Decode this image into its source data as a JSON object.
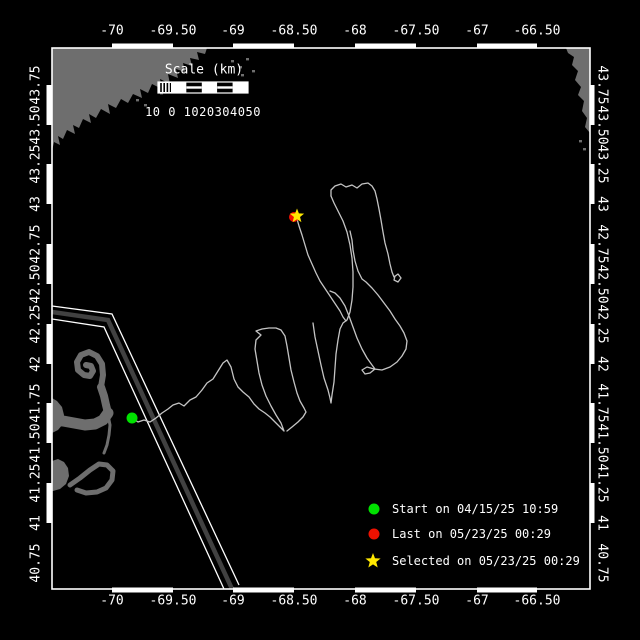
{
  "figure": {
    "width": 640,
    "height": 640,
    "background": "#000000"
  },
  "colors": {
    "frame": "#ffffff",
    "text": "#ffffff",
    "land": "#6e6e6e",
    "track": "#c4c4c4",
    "lane_band": "#414141",
    "lane_line": "#ffffff",
    "start": "#00e100",
    "last": "#ee1100",
    "selected": "#ffe800"
  },
  "plot": {
    "left": 52,
    "top": 48,
    "right": 590,
    "bottom": 589
  },
  "axes": {
    "top": {
      "labels": [
        "-70",
        "-69.50",
        "-69",
        "-68.50",
        "-68",
        "-67.50",
        "-67",
        "-66.50"
      ],
      "x": [
        112,
        173,
        233,
        294,
        355,
        416,
        477,
        537
      ],
      "y": 31
    },
    "bottom": {
      "labels": [
        "-70",
        "-69.50",
        "-69",
        "-68.50",
        "-68",
        "-67.50",
        "-67",
        "-66.50"
      ],
      "x": [
        112,
        173,
        233,
        294,
        355,
        416,
        477,
        537
      ],
      "y": 601
    },
    "left": {
      "labels": [
        "43.75",
        "43.50",
        "43.25",
        "43",
        "42.75",
        "42.50",
        "42.25",
        "42",
        "41.75",
        "41.50",
        "41.25",
        "41",
        "40.75"
      ],
      "y": [
        85,
        125,
        164,
        204,
        244,
        284,
        324,
        364,
        403,
        443,
        483,
        523,
        563
      ],
      "x": 36
    },
    "right": {
      "labels": [
        "43.75",
        "43.50",
        "43.25",
        "43",
        "42.75",
        "42.50",
        "42.25",
        "42",
        "41.75",
        "41.50",
        "41.25",
        "41",
        "40.75"
      ],
      "y": [
        85,
        125,
        164,
        204,
        244,
        284,
        324,
        364,
        403,
        443,
        483,
        523,
        563
      ],
      "x": 602
    }
  },
  "scalebar": {
    "title": "Scale (km)",
    "numbers": "10 0 1020304050",
    "title_cx": 204,
    "title_cy": 70,
    "nums_cx": 203,
    "nums_cy": 112,
    "x": 158,
    "y": 82,
    "w": 90,
    "h": 11,
    "hatch_end": 171,
    "segments": [
      171,
      186.4,
      201.8,
      217.2,
      232.6,
      248
    ]
  },
  "legend": {
    "marker_x": 374,
    "label_x": 392,
    "items": [
      {
        "label": "Start on 04/15/25 10:59",
        "marker": "circle",
        "color": "start",
        "y": 509
      },
      {
        "label": "Last on 05/23/25 00:29",
        "marker": "circle",
        "color": "last",
        "y": 534
      },
      {
        "label": "Selected on 05/23/25 00:29",
        "marker": "star",
        "color": "selected",
        "y": 561
      }
    ]
  },
  "markers": {
    "start": {
      "x": 132,
      "y": 418,
      "r": 5.5
    },
    "last": {
      "x": 294,
      "y": 217,
      "r": 5
    },
    "selected": {
      "x": 297,
      "y": 216,
      "R": 7.5,
      "r": 3.2
    }
  },
  "track": {
    "polylines": [
      [
        [
          132,
          418
        ],
        [
          138,
          422
        ],
        [
          144,
          420
        ],
        [
          150,
          422
        ],
        [
          156,
          418
        ],
        [
          162,
          413
        ],
        [
          168,
          409
        ],
        [
          173,
          405
        ],
        [
          179,
          403
        ],
        [
          184,
          406
        ],
        [
          190,
          400
        ],
        [
          196,
          397
        ],
        [
          202,
          390
        ],
        [
          207,
          383
        ],
        [
          213,
          379
        ],
        [
          218,
          371
        ],
        [
          223,
          363
        ],
        [
          227,
          360
        ],
        [
          231,
          367
        ],
        [
          234,
          379
        ],
        [
          238,
          387
        ],
        [
          243,
          392
        ],
        [
          249,
          397
        ],
        [
          254,
          404
        ],
        [
          259,
          409
        ],
        [
          265,
          413
        ],
        [
          270,
          417
        ],
        [
          275,
          422
        ],
        [
          280,
          427
        ],
        [
          284,
          431
        ],
        [
          281,
          423
        ],
        [
          276,
          415
        ],
        [
          271,
          406
        ],
        [
          266,
          396
        ],
        [
          262,
          385
        ],
        [
          259,
          373
        ],
        [
          257,
          361
        ],
        [
          255,
          349
        ],
        [
          256,
          340
        ],
        [
          261,
          335
        ],
        [
          256,
          331
        ],
        [
          262,
          329
        ],
        [
          269,
          328
        ],
        [
          276,
          328
        ],
        [
          281,
          330
        ],
        [
          285,
          336
        ],
        [
          287,
          346
        ],
        [
          289,
          358
        ],
        [
          291,
          370
        ],
        [
          294,
          382
        ],
        [
          297,
          393
        ],
        [
          300,
          401
        ],
        [
          304,
          408
        ],
        [
          306,
          412
        ],
        [
          303,
          417
        ],
        [
          298,
          422
        ],
        [
          292,
          427
        ],
        [
          287,
          431
        ]
      ],
      [
        [
          313,
          323
        ],
        [
          315,
          337
        ],
        [
          318,
          351
        ],
        [
          321,
          365
        ],
        [
          324,
          378
        ],
        [
          328,
          390
        ],
        [
          330,
          398
        ],
        [
          331,
          403
        ],
        [
          332,
          395
        ],
        [
          334,
          382
        ],
        [
          335,
          368
        ],
        [
          336,
          354
        ],
        [
          338,
          340
        ],
        [
          340,
          329
        ],
        [
          343,
          323
        ],
        [
          347,
          320
        ],
        [
          350,
          312
        ],
        [
          352,
          300
        ],
        [
          353,
          287
        ],
        [
          353,
          272
        ],
        [
          352,
          258
        ],
        [
          350,
          245
        ],
        [
          347,
          232
        ],
        [
          343,
          221
        ],
        [
          338,
          211
        ],
        [
          334,
          203
        ],
        [
          331,
          196
        ]
      ],
      [
        [
          331,
          196
        ],
        [
          331,
          190
        ],
        [
          335,
          186
        ],
        [
          341,
          184
        ],
        [
          346,
          187
        ],
        [
          352,
          185
        ],
        [
          357,
          188
        ],
        [
          362,
          184
        ],
        [
          368,
          183
        ],
        [
          372,
          186
        ],
        [
          375,
          191
        ],
        [
          377,
          199
        ],
        [
          379,
          209
        ],
        [
          381,
          220
        ],
        [
          383,
          232
        ],
        [
          385,
          243
        ],
        [
          388,
          254
        ],
        [
          390,
          264
        ],
        [
          392,
          272
        ],
        [
          394,
          277
        ],
        [
          398,
          274
        ],
        [
          401,
          278
        ],
        [
          398,
          282
        ],
        [
          394,
          280
        ],
        [
          395,
          276
        ]
      ],
      [
        [
          330,
          291
        ],
        [
          335,
          293
        ],
        [
          340,
          298
        ],
        [
          345,
          306
        ],
        [
          349,
          316
        ],
        [
          353,
          327
        ],
        [
          357,
          338
        ],
        [
          362,
          349
        ],
        [
          367,
          358
        ],
        [
          372,
          365
        ],
        [
          375,
          369
        ],
        [
          370,
          373
        ],
        [
          365,
          374
        ],
        [
          362,
          370
        ],
        [
          367,
          367
        ],
        [
          374,
          369
        ],
        [
          382,
          370
        ],
        [
          390,
          367
        ],
        [
          397,
          362
        ],
        [
          402,
          356
        ],
        [
          406,
          349
        ],
        [
          407,
          341
        ],
        [
          404,
          333
        ],
        [
          400,
          326
        ],
        [
          395,
          319
        ],
        [
          390,
          311
        ],
        [
          384,
          303
        ],
        [
          378,
          295
        ],
        [
          372,
          288
        ],
        [
          366,
          282
        ],
        [
          362,
          279
        ],
        [
          358,
          271
        ],
        [
          355,
          261
        ],
        [
          353,
          250
        ],
        [
          352,
          240
        ],
        [
          350,
          231
        ]
      ],
      [
        [
          297,
          219
        ],
        [
          299,
          226
        ],
        [
          302,
          235
        ],
        [
          305,
          245
        ],
        [
          308,
          255
        ],
        [
          312,
          264
        ],
        [
          316,
          273
        ],
        [
          320,
          281
        ],
        [
          324,
          287
        ],
        [
          328,
          293
        ],
        [
          332,
          299
        ],
        [
          336,
          305
        ],
        [
          340,
          311
        ],
        [
          343,
          317
        ],
        [
          346,
          321
        ]
      ]
    ]
  },
  "land": {
    "polygons": [
      {
        "name": "maine-coast",
        "pts": [
          [
            52,
            48
          ],
          [
            207,
            48
          ],
          [
            205,
            54
          ],
          [
            197,
            52
          ],
          [
            199,
            60
          ],
          [
            190,
            58
          ],
          [
            192,
            66
          ],
          [
            183,
            63
          ],
          [
            185,
            72
          ],
          [
            176,
            69
          ],
          [
            178,
            78
          ],
          [
            168,
            74
          ],
          [
            170,
            84
          ],
          [
            160,
            79
          ],
          [
            162,
            89
          ],
          [
            152,
            84
          ],
          [
            148,
            93
          ],
          [
            140,
            89
          ],
          [
            142,
            98
          ],
          [
            133,
            94
          ],
          [
            128,
            103
          ],
          [
            121,
            99
          ],
          [
            116,
            108
          ],
          [
            108,
            104
          ],
          [
            110,
            114
          ],
          [
            101,
            109
          ],
          [
            96,
            118
          ],
          [
            89,
            114
          ],
          [
            91,
            123
          ],
          [
            83,
            119
          ],
          [
            79,
            128
          ],
          [
            73,
            125
          ],
          [
            75,
            134
          ],
          [
            67,
            130
          ],
          [
            63,
            139
          ],
          [
            58,
            136
          ],
          [
            60,
            145
          ],
          [
            54,
            142
          ],
          [
            52,
            151
          ]
        ]
      },
      {
        "name": "nova-scotia",
        "pts": [
          [
            566,
            48
          ],
          [
            590,
            48
          ],
          [
            590,
            133
          ],
          [
            585,
            127
          ],
          [
            587,
            118
          ],
          [
            582,
            111
          ],
          [
            584,
            101
          ],
          [
            578,
            95
          ],
          [
            581,
            87
          ],
          [
            575,
            80
          ],
          [
            578,
            71
          ],
          [
            572,
            65
          ],
          [
            574,
            57
          ],
          [
            568,
            53
          ]
        ]
      },
      {
        "name": "capecod-shoulder",
        "pts": [
          [
            52,
            398
          ],
          [
            57,
            401
          ],
          [
            62,
            407
          ],
          [
            64,
            415
          ],
          [
            63,
            424
          ],
          [
            58,
            430
          ],
          [
            52,
            433
          ]
        ]
      },
      {
        "name": "island-west-blob",
        "pts": [
          [
            52,
            461
          ],
          [
            58,
            459
          ],
          [
            64,
            462
          ],
          [
            68,
            468
          ],
          [
            69,
            476
          ],
          [
            66,
            484
          ],
          [
            60,
            489
          ],
          [
            53,
            491
          ],
          [
            52,
            491
          ]
        ]
      }
    ],
    "strokes": [
      {
        "name": "provincetown-hook",
        "w": 6,
        "pts": [
          [
            101,
            387
          ],
          [
            103,
            375
          ],
          [
            102,
            364
          ],
          [
            97,
            356
          ],
          [
            89,
            352
          ],
          [
            81,
            355
          ],
          [
            77,
            362
          ],
          [
            78,
            370
          ],
          [
            84,
            375
          ],
          [
            90,
            376
          ],
          [
            93,
            371
          ],
          [
            91,
            366
          ],
          [
            86,
            365
          ]
        ]
      },
      {
        "name": "cape-forearm",
        "w": 8,
        "pts": [
          [
            101,
            387
          ],
          [
            104,
            396
          ],
          [
            106,
            405
          ],
          [
            108,
            413
          ]
        ]
      },
      {
        "name": "cape-arm",
        "w": 11,
        "pts": [
          [
            108,
            413
          ],
          [
            103,
            420
          ],
          [
            95,
            424
          ],
          [
            85,
            425
          ],
          [
            74,
            423
          ],
          [
            63,
            421
          ],
          [
            52,
            420
          ]
        ]
      },
      {
        "name": "chatham-spit",
        "w": 3,
        "pts": [
          [
            108,
            415
          ],
          [
            110,
            425
          ],
          [
            109,
            435
          ],
          [
            107,
            445
          ],
          [
            104,
            453
          ]
        ]
      },
      {
        "name": "island-arc",
        "w": 5,
        "pts": [
          [
            70,
            485
          ],
          [
            80,
            478
          ],
          [
            90,
            470
          ],
          [
            99,
            464
          ],
          [
            107,
            465
          ],
          [
            113,
            471
          ],
          [
            112,
            480
          ],
          [
            106,
            488
          ],
          [
            97,
            492
          ],
          [
            86,
            493
          ],
          [
            77,
            490
          ]
        ]
      }
    ],
    "specks": [
      [
        231,
        60
      ],
      [
        239,
        66
      ],
      [
        246,
        58
      ],
      [
        252,
        70
      ],
      [
        128,
        93
      ],
      [
        136,
        99
      ],
      [
        144,
        104
      ],
      [
        241,
        74
      ],
      [
        160,
        92
      ],
      [
        579,
        140
      ],
      [
        583,
        148
      ]
    ]
  },
  "lane": {
    "band": {
      "w": 4.5,
      "pts": [
        [
          52,
          312
        ],
        [
          108,
          320
        ],
        [
          232,
          589
        ]
      ]
    },
    "lines": [
      {
        "w": 1.3,
        "pts": [
          [
            52,
            306
          ],
          [
            112,
            314
          ],
          [
            239,
            585
          ]
        ]
      },
      {
        "w": 1.3,
        "pts": [
          [
            52,
            319
          ],
          [
            104,
            327
          ],
          [
            224,
            589
          ]
        ]
      }
    ]
  }
}
